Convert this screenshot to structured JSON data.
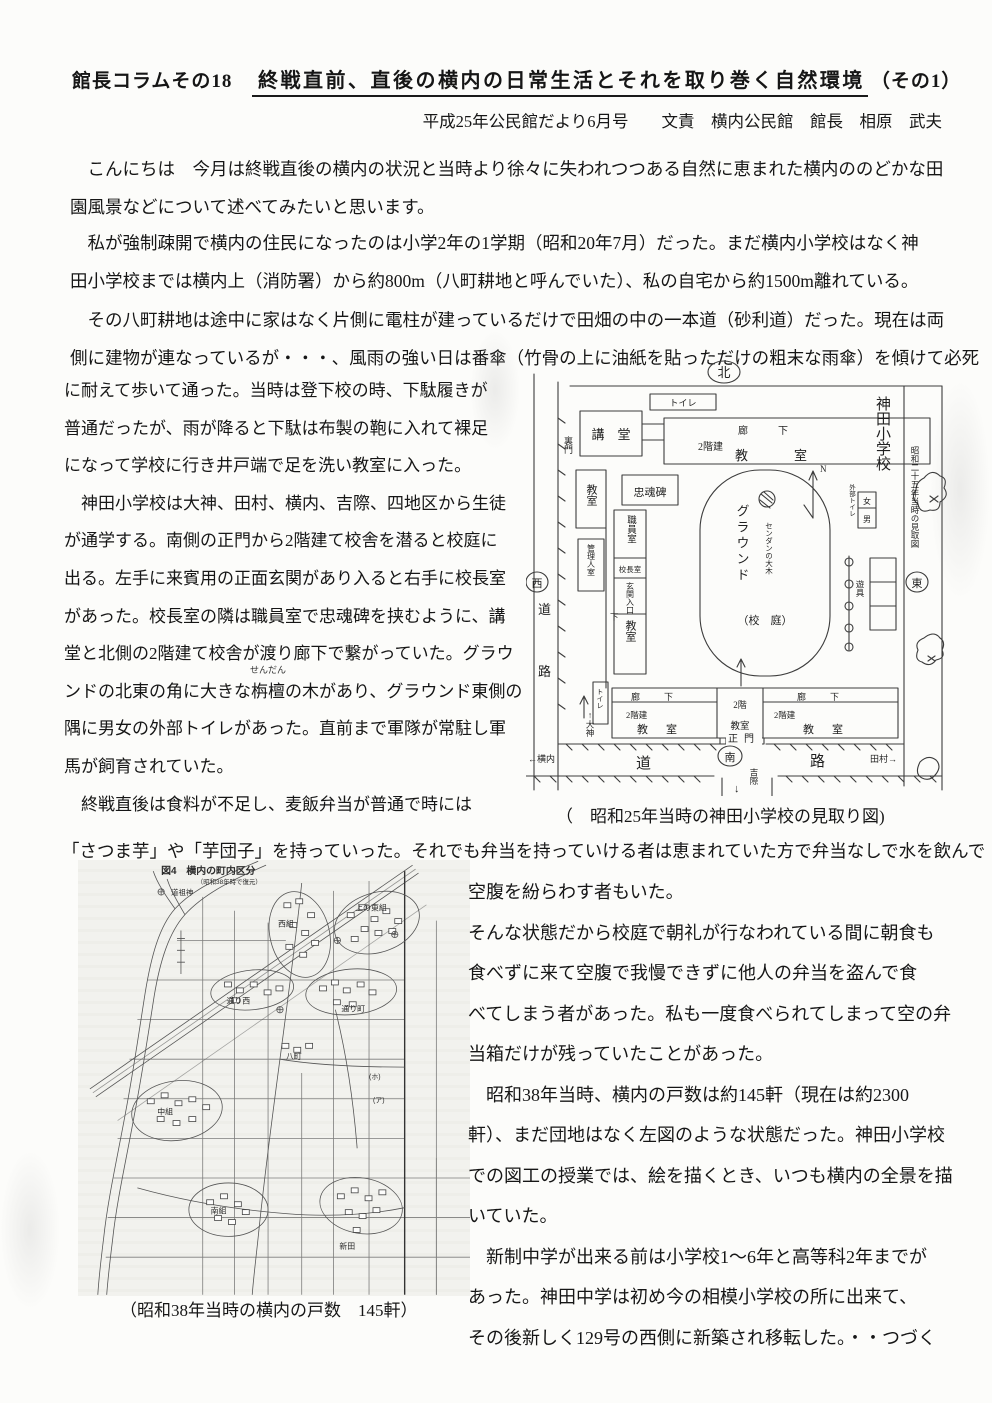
{
  "header": {
    "column_label": "館長コラムその18",
    "title": "終戦直前、直後の横内の日常生活とそれを取り巻く自然環境",
    "title_suffix": "（その1）",
    "byline": "平成25年公民館だより6月号　　文責　横内公民館　館長　相原　武夫"
  },
  "intro": {
    "p1": [
      "　こんにちは　今月は終戦直後の横内の状況と当時より徐々に失われつつある自然に恵まれた横内ののどかな田",
      "園風景などについて述べてみたいと思います。"
    ],
    "p2": [
      "　私が強制疎開で横内の住民になったのは小学2年の1学期（昭和20年7月）だった。まだ横内小学校はなく神",
      "田小学校までは横内上（消防署）から約800m（八町耕地と呼んでいた）、私の自宅から約1500m離れている。"
    ],
    "p3": [
      "　その八町耕地は途中に家はなく片側に電柱が建っているだけで田畑の中の一本道（砂利道）だった。現在は両",
      "側に建物が連なっているが・・・、風雨の強い日は番傘（竹骨の上に油紙を貼っただけの粗末な雨傘）を傾けて必死"
    ]
  },
  "left_column": {
    "lines_a": [
      "に耐えて歩いて通った。当時は登下校の時、下駄履きが",
      "普通だったが、雨が降ると下駄は布製の鞄に入れて裸足",
      "になって学校に行き井戸端で足を洗い教室に入った。",
      "　神田小学校は大神、田村、横内、吉際、四地区から生徒",
      "が通学する。南側の正門から2階建て校舎を潜ると校庭に",
      "出る。左手に来賓用の正面玄関があり入ると右手に校長室",
      "があった。校長室の隣は職員室で忠魂碑を挟むように、講",
      "堂と北側の2階建て校舎が渡り廊下で繋がっていた。グラウ"
    ],
    "ruby_line": {
      "pre": "ンドの北東の角に大きな",
      "base": "栴檀",
      "rt": "せんだん",
      "post": "の木があり、グラウンド東側の"
    },
    "lines_b": [
      "隅に男女の外部トイレがあった。直前まで軍隊が常駐し軍",
      "馬が飼育されていた。",
      "　終戦直後は食料が不足し、麦飯弁当が普通で時には"
    ]
  },
  "bridge_line": "「さつま芋」や「芋団子」を持っていった。それでも弁当を持っていける者は恵まれていた方で弁当なしで水を飲んで",
  "right_column": {
    "lines": [
      "空腹を紛らわす者もいた。",
      "そんな状態だから校庭で朝礼が行なわれている間に朝食も",
      "食べずに来て空腹で我慢できずに他人の弁当を盗んで食",
      "べてしまう者があった。私も一度食べられてしまって空の弁",
      "当箱だけが残っていたことがあった。",
      "　昭和38年当時、横内の戸数は約145軒（現在は約2300",
      "軒）、まだ団地はなく左図のような状態だった。神田小学校",
      "での図工の授業では、絵を描くとき、いつも横内の全景を描",
      "いていた。",
      "　新制中学が出来る前は小学校1～6年と高等科2年までが",
      "あった。神田中学は初め今の相模小学校の所に出来て、",
      "その後新しく129号の西側に新築され移転した。・・つづく"
    ]
  },
  "school_map": {
    "caption": "（　昭和25年当時の神田小学校の見取り図)",
    "labels": {
      "north": "北",
      "west": "西",
      "east": "東",
      "south": "南",
      "road_v_top": "道",
      "road_v_bottom": "路",
      "road_h_left": "道",
      "road_h_right": "路",
      "back_gate": "裏門",
      "toilet": "トイレ",
      "auditorium": "講　堂",
      "corridor": "廊下",
      "two_story": "2階建",
      "classroom": "教室",
      "memorial": "忠魂碑",
      "staff_room": "職員室",
      "principal_room": "校長室",
      "caretaker_room": "管理人室",
      "entrance": "玄関入口",
      "corridor_down": "下",
      "ground": "グラウンド",
      "ground_sub": "（校　庭）",
      "big_tree": "センダンの大木",
      "north_n": "N",
      "outer_toilet": "外部トイレ",
      "female": "女",
      "male": "男",
      "play_equipment": "遊具",
      "school_name": "神田小学校",
      "school_name_sub": "昭和二十五年当時の見取図",
      "mid_room_floor": "2階",
      "mid_room": "教室",
      "main_gate": "正門",
      "to_yokouchi": "←横内",
      "to_tamura": "田村→",
      "to_okami": "↑大神",
      "down_arrow": "↓",
      "to_kissai": "吉際"
    }
  },
  "town_map": {
    "fig_title": "図4　横内の町内区分",
    "fig_subtitle": "（昭和38年時で復元）",
    "legend": "道祖神",
    "caption": "（昭和38年当時の横内の戸数　145軒）",
    "areas": {
      "kami_higashi": "上の東組",
      "nishi": "西組",
      "tori_nishi": "通り西",
      "tori_machi": "通り町",
      "haccho": "八町",
      "naka": "中組",
      "minami": "南組",
      "shinden": "新田"
    },
    "marks": {
      "ho": "(ホ)",
      "a": "(ア)"
    }
  }
}
